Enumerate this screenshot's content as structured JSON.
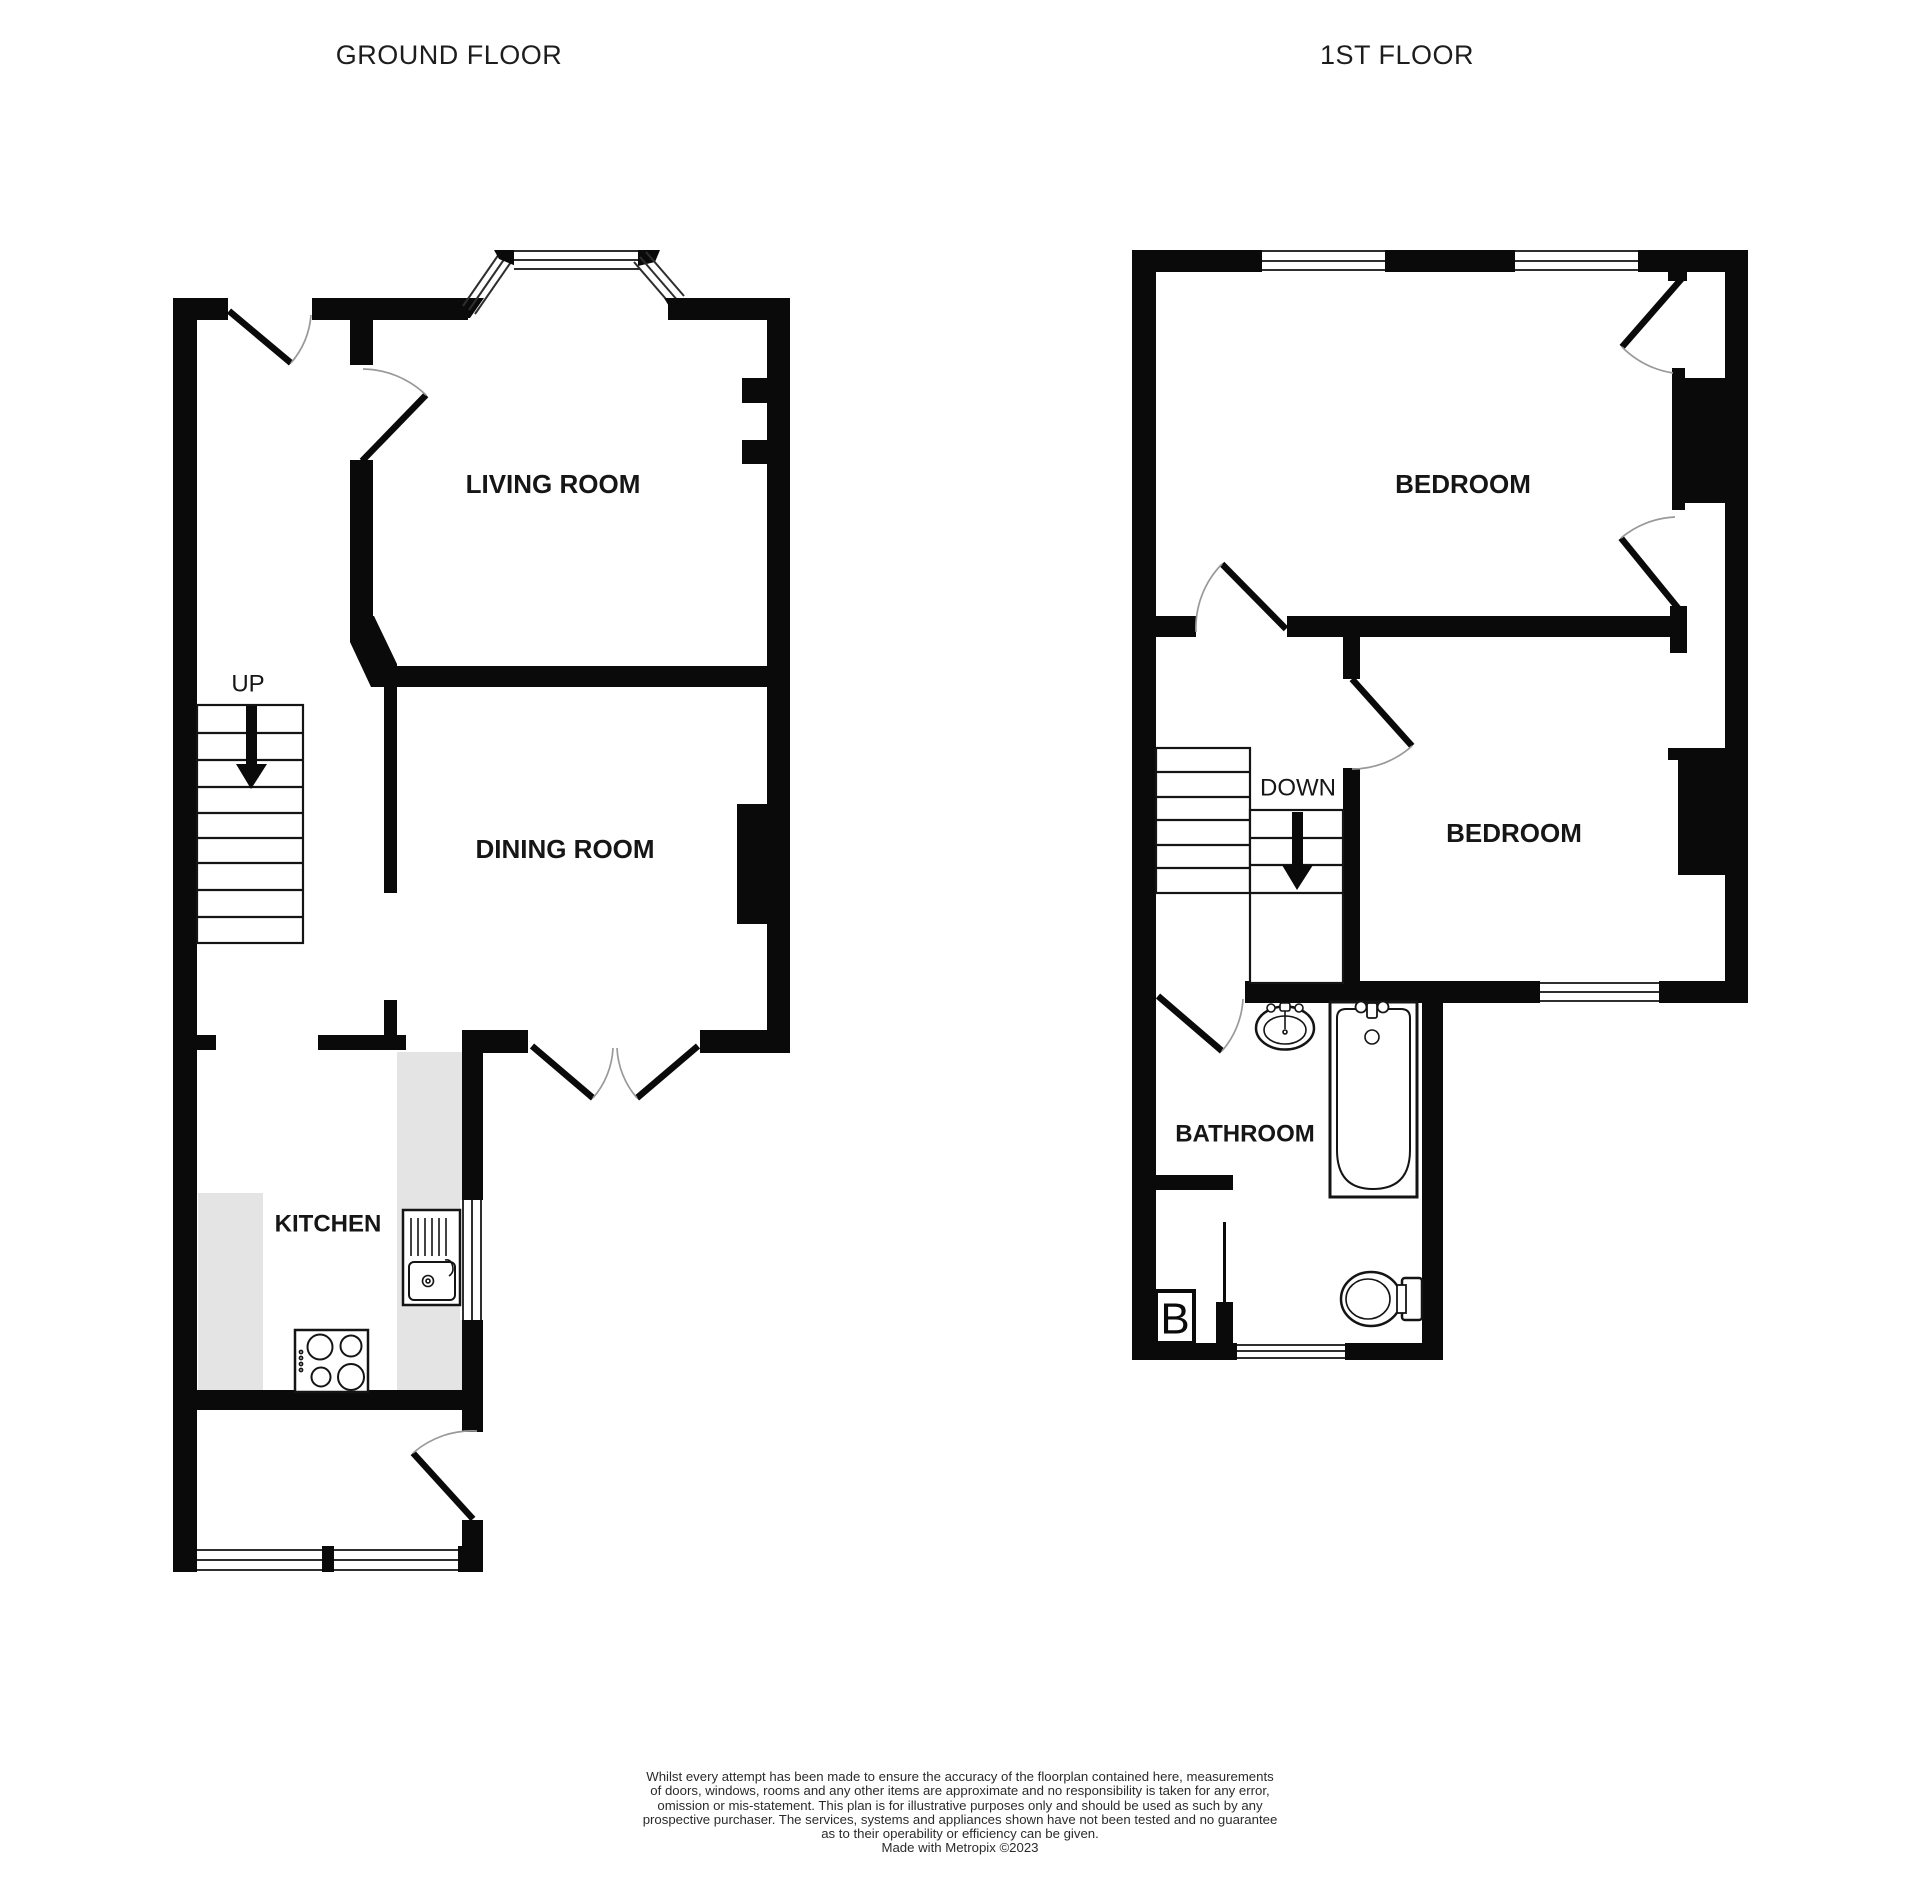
{
  "header": {
    "ground_floor_title": "GROUND FLOOR",
    "first_floor_title": "1ST FLOOR"
  },
  "ground_floor": {
    "rooms": {
      "living_room": "LIVING ROOM",
      "dining_room": "DINING ROOM",
      "kitchen": "KITCHEN"
    },
    "stairs_direction": "UP"
  },
  "first_floor": {
    "rooms": {
      "bedroom_front": "BEDROOM",
      "bedroom_back": "BEDROOM",
      "bathroom": "BATHROOM"
    },
    "stairs_direction": "DOWN",
    "boiler_label": "B"
  },
  "footer": {
    "disclaimer_lines": [
      "Whilst every attempt has been made to ensure the accuracy of the floorplan contained here, measurements",
      "of doors, windows, rooms and any other items are approximate and no responsibility is taken for any error,",
      "omission or mis-statement. This plan is for illustrative purposes only and should be used as such by any",
      "prospective purchaser. The services, systems and appliances shown have not been tested and no guarantee",
      "as to their operability or efficiency can be given."
    ],
    "credit": "Made with Metropix ©2023"
  }
}
